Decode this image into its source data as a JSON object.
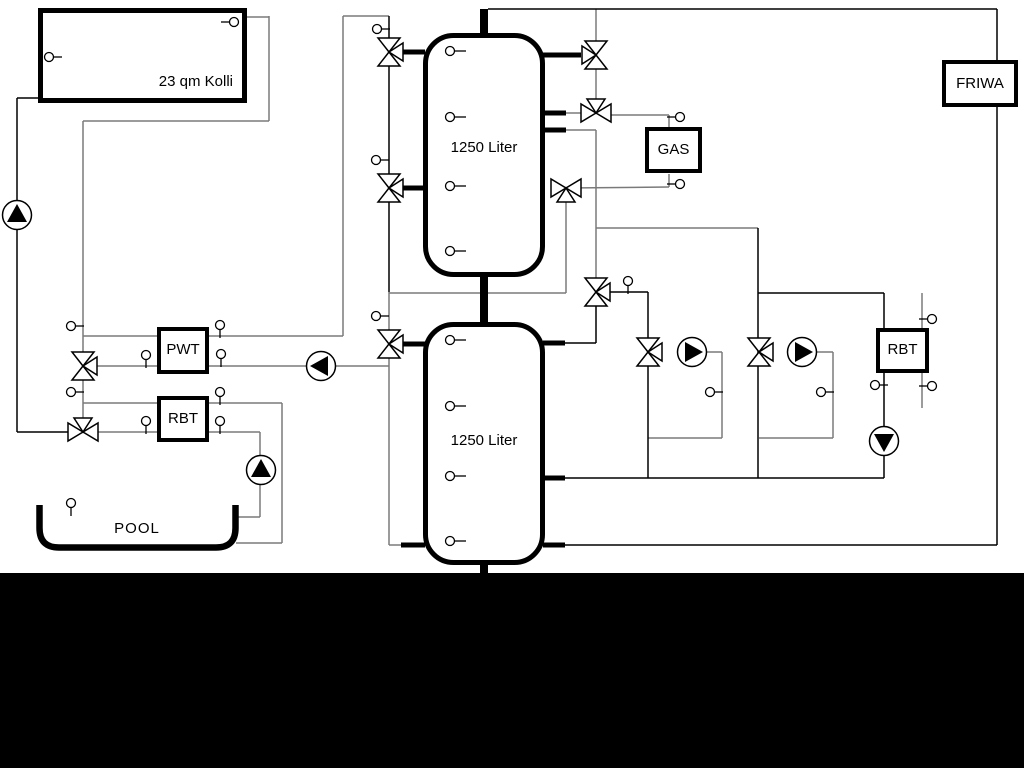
{
  "diagram_title": "heating-system-hydraulic-schematic",
  "labels": {
    "solar_collector": "23 qm Kolli",
    "buffer_tank_top": "1250 Liter",
    "buffer_tank_bottom": "1250 Liter",
    "gas_boiler": "GAS",
    "fresh_water_station": "FRIWA",
    "pool_heat_exchanger": "PWT",
    "rbt_left": "RBT",
    "rbt_right": "RBT",
    "pool": "POOL"
  },
  "colors": {
    "pipe_gray": "#7a7a7a",
    "pipe_black": "#000000",
    "equipment_stroke": "#000000",
    "equipment_fill": "#ffffff",
    "background": "#ffffff",
    "bottom_band": "#000000"
  }
}
